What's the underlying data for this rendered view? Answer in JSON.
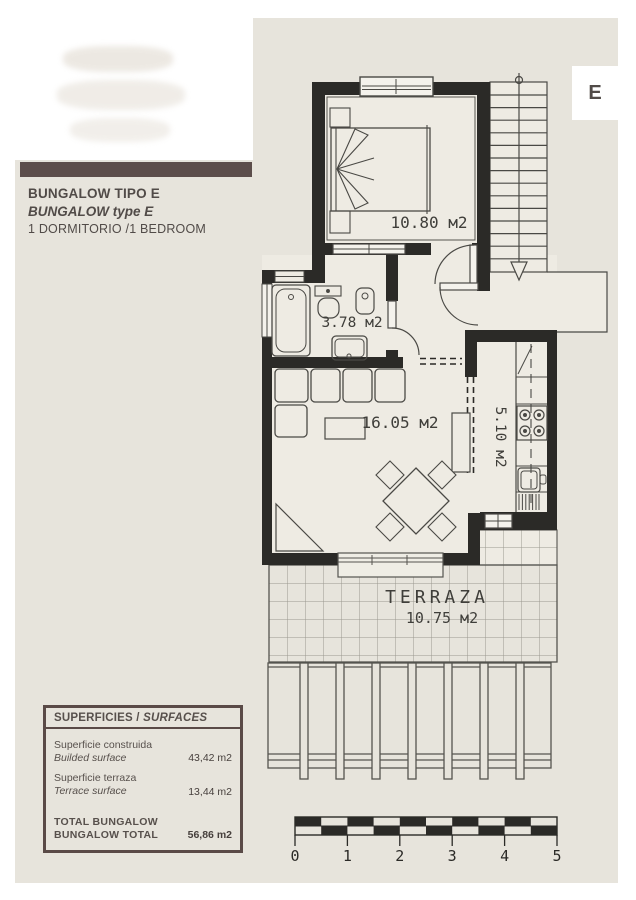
{
  "header": {
    "title_es": "BUNGALOW TIPO E",
    "title_en": "BUNGALOW type E",
    "subtitle": "1 DORMITORIO /1 BEDROOM",
    "unit_letter": "E"
  },
  "plan": {
    "bedroom_area": "10.80 м2",
    "bathroom_area": "3.78 м2",
    "living_area": "16.05 м2",
    "kitchen_area": "5.10 м2",
    "terrace_label": "TERRAZA",
    "terrace_area": "10.75 м2"
  },
  "surfaces_table": {
    "header_es": "SUPERFICIES",
    "header_sep": " / ",
    "header_en": "SURFACES",
    "rows": [
      {
        "label_es": "Superficie construida",
        "label_en": "Builded surface",
        "value": "43,42 m2"
      },
      {
        "label_es": "Superficie terraza",
        "label_en": "Terrace surface",
        "value": "13,44 m2"
      }
    ],
    "total": {
      "label_es": "TOTAL BUNGALOW",
      "label_en": "BUNGALOW TOTAL",
      "value": "56,86 m2"
    }
  },
  "scale_bar": {
    "labels": [
      "0",
      "1",
      "2",
      "3",
      "4",
      "5"
    ]
  },
  "colors": {
    "wall": "#2b2a27",
    "accent_maroon": "#5c4d4b",
    "canvas": "#e7e4dc"
  }
}
